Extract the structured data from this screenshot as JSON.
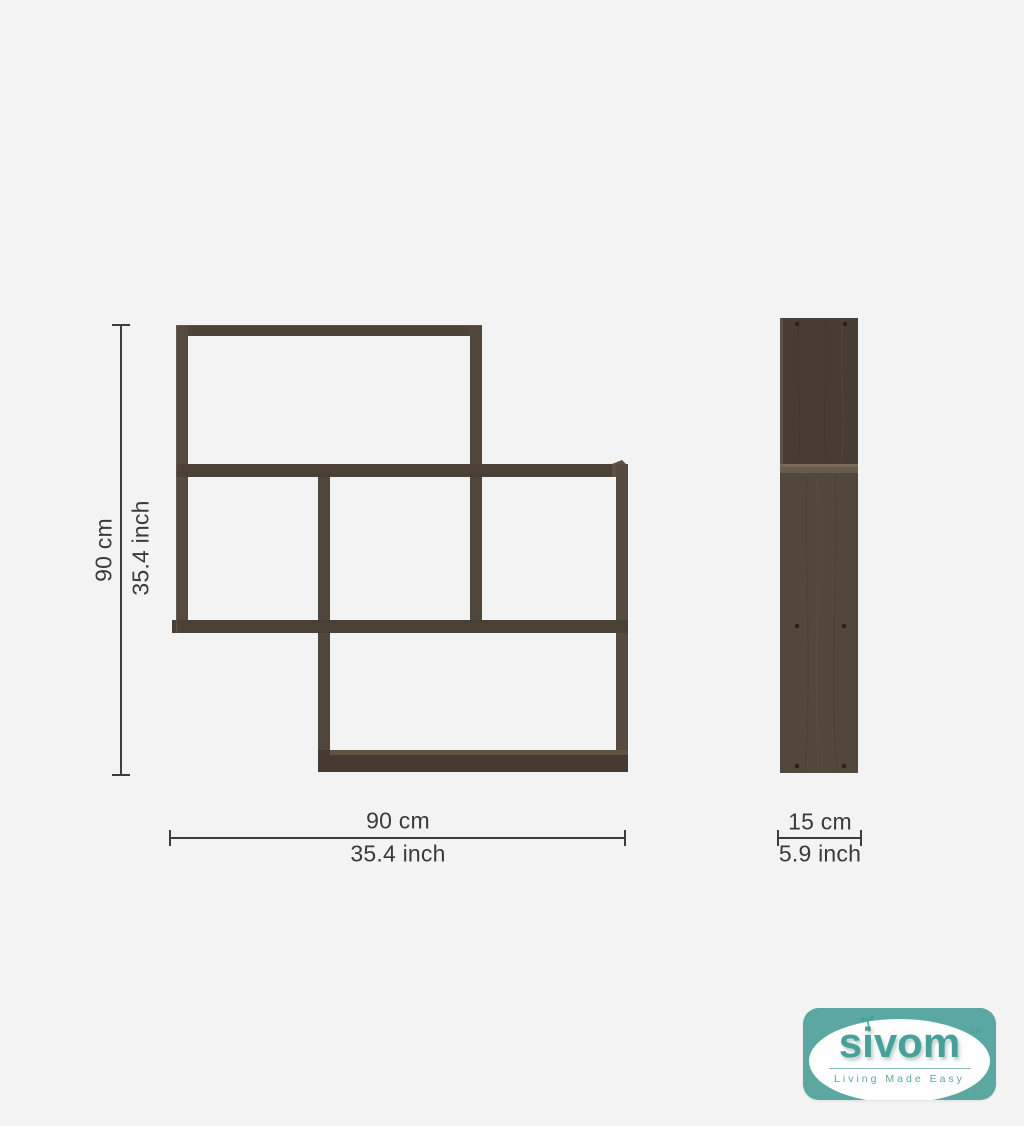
{
  "colors": {
    "wood": "#4e4339",
    "wood_dark": "#473d34",
    "wood_light": "#6a5c4b",
    "dimension": "#3d3d3d",
    "brand_teal": "#5ba8a2",
    "brand_text": "#47a09a",
    "page_bg": "#f2f3f2"
  },
  "dimensions": {
    "height": {
      "cm": "90 cm",
      "inch": "35.4 inch"
    },
    "width": {
      "cm": "90 cm",
      "inch": "35.4 inch"
    },
    "depth": {
      "cm": "15 cm",
      "inch": "5.9 inch"
    }
  },
  "logo": {
    "brand": "sivom",
    "trademark": "TM",
    "tagline": "Living Made Easy"
  }
}
